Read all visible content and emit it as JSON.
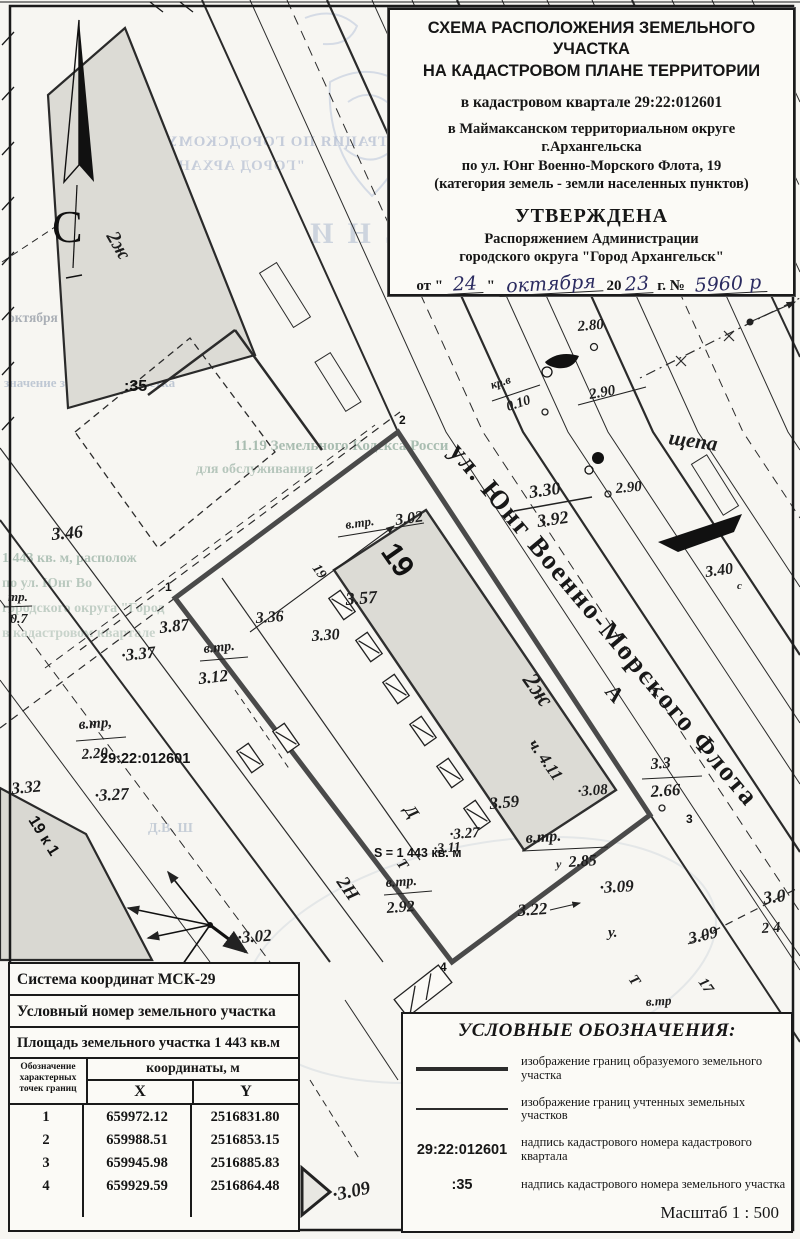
{
  "title_block": {
    "line1": "СХЕМА РАСПОЛОЖЕНИЯ ЗЕМЕЛЬНОГО УЧАСТКА",
    "line2": "НА КАДАСТРОВОМ ПЛАНЕ ТЕРРИТОРИИ",
    "quarter": "в кадастровом квартале 29:22:012601",
    "district1": "в Маймаксанском территориальном округе",
    "district2": "г.Архангельска",
    "address": "по ул. Юнг Военно-Морского Флота, 19",
    "category": "(категория земель - земли населенных пунктов)",
    "approved": "УТВЕРЖДЕНА",
    "approved_by1": "Распоряжением Администрации",
    "approved_by2": "городского округа \"Город Архангельск\"",
    "date_prefix": "от \"",
    "date_day": "24",
    "date_q2": "\"",
    "date_month": "октября",
    "date_20": "20",
    "date_year": "23",
    "date_suffix": "г. №",
    "doc_number": "5960 р"
  },
  "coord_table": {
    "row1": "Система координат МСК-29",
    "row2": "Условный номер земельного участка",
    "row3": "Площадь земельного участка 1 443 кв.м",
    "head_col1a": "Обозначение",
    "head_col1b": "характерных",
    "head_col1c": "точек границ",
    "head_coords": "координаты, м",
    "head_x": "X",
    "head_y": "Y",
    "rows": [
      {
        "n": "1",
        "x": "659972.12",
        "y": "2516831.80"
      },
      {
        "n": "2",
        "x": "659988.51",
        "y": "2516853.15"
      },
      {
        "n": "3",
        "x": "659945.98",
        "y": "2516885.83"
      },
      {
        "n": "4",
        "x": "659929.59",
        "y": "2516864.48"
      }
    ]
  },
  "legend": {
    "title": "УСЛОВНЫЕ ОБОЗНАЧЕНИЯ:",
    "item1_text": "изображение границ образуемого земельного участка",
    "item2_text": "изображение границ учтенных земельных участков",
    "item3_code": "29:22:012601",
    "item3_text": "надпись кадастрового номера кадастрового квартала",
    "item4_code": ":35",
    "item4_text": "надпись кадастрового номера земельного участка",
    "scale": "Масштаб  1 : 500"
  },
  "map": {
    "north_label": "С",
    "area_label": "S = 1 443 кв. м",
    "labels": [
      {
        "t": "С",
        "x": 52,
        "y": 242,
        "r": 0,
        "s": 46,
        "c": "north"
      },
      {
        "t": "ул. Юнг Военно-Морского Флота",
        "x": 448,
        "y": 452,
        "r": 50,
        "s": 27,
        "c": "name"
      },
      {
        "t": "А",
        "x": 604,
        "y": 692,
        "r": 50,
        "s": 22,
        "c": "name"
      },
      {
        "t": "щепа",
        "x": 668,
        "y": 444,
        "r": 8,
        "s": 21,
        "c": "el"
      },
      {
        "t": "2ж",
        "x": 106,
        "y": 236,
        "r": 60,
        "s": 20,
        "c": "el"
      },
      {
        "t": "2ж",
        "x": 522,
        "y": 680,
        "r": 55,
        "s": 24,
        "c": "el"
      },
      {
        "t": "19",
        "x": 380,
        "y": 552,
        "r": 55,
        "s": 30,
        "c": "sans"
      },
      {
        "t": "19",
        "x": 312,
        "y": 568,
        "r": 55,
        "s": 14,
        "c": "el"
      },
      {
        "t": "19 к 1",
        "x": 28,
        "y": 820,
        "r": 58,
        "s": 16,
        "c": "sans"
      },
      {
        "t": "2Н",
        "x": 336,
        "y": 882,
        "r": 55,
        "s": 19,
        "c": "el"
      },
      {
        "t": "Д",
        "x": 404,
        "y": 810,
        "r": 55,
        "s": 17,
        "c": "el"
      },
      {
        "t": "17",
        "x": 698,
        "y": 982,
        "r": 55,
        "s": 15,
        "c": "el"
      },
      {
        "t": "ч. 4.11",
        "x": 528,
        "y": 744,
        "r": 55,
        "s": 17,
        "c": "el"
      },
      {
        "t": ":35",
        "x": 124,
        "y": 391,
        "r": 0,
        "s": 16,
        "c": "sans"
      },
      {
        "t": "29:22:012601",
        "x": 100,
        "y": 763,
        "r": 0,
        "s": 14.5,
        "c": "sans"
      },
      {
        "t": "S = 1 443 кв. м",
        "x": 374,
        "y": 857,
        "r": 0,
        "s": 12.5,
        "c": "sans"
      },
      {
        "t": "1",
        "x": 165,
        "y": 591,
        "r": 0,
        "s": 12,
        "c": "pt"
      },
      {
        "t": "2",
        "x": 399,
        "y": 424,
        "r": 0,
        "s": 12,
        "c": "pt"
      },
      {
        "t": "3",
        "x": 686,
        "y": 823,
        "r": 0,
        "s": 12,
        "c": "pt"
      },
      {
        "t": "4",
        "x": 440,
        "y": 971,
        "r": 0,
        "s": 12,
        "c": "pt"
      },
      {
        "t": "3.46",
        "x": 52,
        "y": 540,
        "r": -5,
        "s": 18,
        "c": "el"
      },
      {
        "t": "тр.",
        "x": 8,
        "y": 601,
        "r": 0,
        "s": 13,
        "c": "el"
      },
      {
        "t": "0.7",
        "x": 10,
        "y": 623,
        "r": 0,
        "s": 14,
        "c": "el"
      },
      {
        "t": "3.87",
        "x": 160,
        "y": 633,
        "r": -6,
        "s": 17,
        "c": "el"
      },
      {
        "t": "·3.37",
        "x": 122,
        "y": 661,
        "r": -6,
        "s": 17,
        "c": "el"
      },
      {
        "t": "в.тр.",
        "x": 204,
        "y": 653,
        "r": -6,
        "s": 14,
        "c": "el"
      },
      {
        "t": "3.12",
        "x": 199,
        "y": 684,
        "r": -6,
        "s": 17,
        "c": "el"
      },
      {
        "t": "в.тр,",
        "x": 79,
        "y": 729,
        "r": -4,
        "s": 15,
        "c": "el"
      },
      {
        "t": "2.20",
        "x": 82,
        "y": 759,
        "r": -4,
        "s": 15,
        "c": "el"
      },
      {
        "t": "3.32",
        "x": 12,
        "y": 794,
        "r": -5,
        "s": 17,
        "c": "el"
      },
      {
        "t": "·3.27",
        "x": 95,
        "y": 801,
        "r": -3,
        "s": 17,
        "c": "el"
      },
      {
        "t": "·3.02",
        "x": 238,
        "y": 943,
        "r": -4,
        "s": 17,
        "c": "el"
      },
      {
        "t": "в.тр.",
        "x": 386,
        "y": 887,
        "r": -4,
        "s": 14,
        "c": "el"
      },
      {
        "t": "2.92",
        "x": 387,
        "y": 913,
        "r": -4,
        "s": 16,
        "c": "el"
      },
      {
        "t": "·3.27",
        "x": 450,
        "y": 839,
        "r": -4,
        "s": 15,
        "c": "el"
      },
      {
        "t": "·3.11",
        "x": 434,
        "y": 853,
        "r": -4,
        "s": 14,
        "c": "el"
      },
      {
        "t": "в.тр.",
        "x": 526,
        "y": 843,
        "r": -4,
        "s": 16,
        "c": "el"
      },
      {
        "t": "у",
        "x": 556,
        "y": 868,
        "r": 0,
        "s": 12,
        "c": "el"
      },
      {
        "t": "2.85",
        "x": 569,
        "y": 867,
        "r": -4,
        "s": 16,
        "c": "el"
      },
      {
        "t": "3.59",
        "x": 490,
        "y": 809,
        "r": -5,
        "s": 17,
        "c": "el"
      },
      {
        "t": "·3.08",
        "x": 578,
        "y": 796,
        "r": -4,
        "s": 15,
        "c": "el"
      },
      {
        "t": "3.3",
        "x": 651,
        "y": 769,
        "r": -4,
        "s": 16,
        "c": "el"
      },
      {
        "t": "2.66",
        "x": 651,
        "y": 797,
        "r": -4,
        "s": 17,
        "c": "el"
      },
      {
        "t": "·3.09",
        "x": 600,
        "y": 893,
        "r": -3,
        "s": 17,
        "c": "el"
      },
      {
        "t": "у.",
        "x": 608,
        "y": 937,
        "r": 0,
        "s": 15,
        "c": "el"
      },
      {
        "t": "3.09",
        "x": 690,
        "y": 944,
        "r": -14,
        "s": 17,
        "c": "el"
      },
      {
        "t": "3.0",
        "x": 764,
        "y": 904,
        "r": -8,
        "s": 18,
        "c": "el"
      },
      {
        "t": "2 4",
        "x": 762,
        "y": 933,
        "r": -4,
        "s": 15,
        "c": "el"
      },
      {
        "t": "в.тр",
        "x": 646,
        "y": 1006,
        "r": -3,
        "s": 13,
        "c": "el"
      },
      {
        "t": "Т",
        "x": 396,
        "y": 863,
        "r": 55,
        "s": 15,
        "c": "el"
      },
      {
        "t": "Т",
        "x": 628,
        "y": 979,
        "r": 55,
        "s": 15,
        "c": "el"
      },
      {
        "t": "3.22",
        "x": 518,
        "y": 916,
        "r": -4,
        "s": 17,
        "c": "el"
      },
      {
        "t": "в.тр.",
        "x": 346,
        "y": 529,
        "r": -8,
        "s": 13,
        "c": "el"
      },
      {
        "t": "3.02",
        "x": 396,
        "y": 525,
        "r": -8,
        "s": 16,
        "c": "el"
      },
      {
        "t": "3.57",
        "x": 346,
        "y": 605,
        "r": -4,
        "s": 18,
        "c": "el"
      },
      {
        "t": "3.36",
        "x": 256,
        "y": 623,
        "r": -4,
        "s": 16,
        "c": "el"
      },
      {
        "t": "3.30",
        "x": 312,
        "y": 641,
        "r": -4,
        "s": 16,
        "c": "el"
      },
      {
        "t": "кр.в",
        "x": 492,
        "y": 389,
        "r": -18,
        "s": 12,
        "c": "el"
      },
      {
        "t": "0.10",
        "x": 508,
        "y": 411,
        "r": -18,
        "s": 14,
        "c": "el"
      },
      {
        "t": "2.90",
        "x": 590,
        "y": 399,
        "r": -10,
        "s": 15,
        "c": "el"
      },
      {
        "t": "2.90",
        "x": 616,
        "y": 493,
        "r": -5,
        "s": 15,
        "c": "el"
      },
      {
        "t": "2.80",
        "x": 578,
        "y": 331,
        "r": -5,
        "s": 15,
        "c": "el"
      },
      {
        "t": "3.40",
        "x": 706,
        "y": 577,
        "r": -8,
        "s": 16,
        "c": "el"
      },
      {
        "t": "с",
        "x": 737,
        "y": 589,
        "r": 0,
        "s": 11,
        "c": "el"
      },
      {
        "t": "3.30",
        "x": 530,
        "y": 498,
        "r": -8,
        "s": 18,
        "c": "el"
      },
      {
        "t": "3.92",
        "x": 538,
        "y": 527,
        "r": -8,
        "s": 18,
        "c": "el"
      },
      {
        "t": "·3.09",
        "x": 334,
        "y": 1201,
        "r": -12,
        "s": 19,
        "c": "el"
      }
    ],
    "bleedthrough": [
      {
        "t": "ТРАЦИЯ ПО ГОРОДСКОМУ ОКРУГУ",
        "x": 388,
        "y": 146,
        "s": 15,
        "color": "#7b90b8",
        "opacity": 0.4,
        "mirror": true,
        "ls": 1
      },
      {
        "t": "\"ГОРОД АРХАНГЕЛЬСК\"",
        "x": 305,
        "y": 170,
        "s": 15,
        "color": "#7b90b8",
        "opacity": 0.38,
        "mirror": true,
        "ls": 1
      },
      {
        "t": "РАСПОРЯЖЕНИ",
        "x": 688,
        "y": 243,
        "s": 30,
        "color": "#8296bb",
        "opacity": 0.35,
        "mirror": true,
        "ls": 14
      },
      {
        "t": "октября 2023 г. №",
        "x": 8,
        "y": 322,
        "s": 13.5,
        "color": "#5f6b7c",
        "opacity": 0.5,
        "mirror": false,
        "ls": 0
      },
      {
        "t": "значение земельного участка",
        "x": 4,
        "y": 387,
        "s": 13,
        "color": "#6e86a8",
        "opacity": 0.4,
        "mirror": false,
        "ls": 0
      },
      {
        "t": "11.19  Земельного  Кодекса  Росси",
        "x": 234,
        "y": 450,
        "s": 15,
        "color": "#5e8672",
        "opacity": 0.5,
        "mirror": false,
        "ls": 0
      },
      {
        "t": "для  обслуживания",
        "x": 196,
        "y": 473,
        "s": 14,
        "color": "#5e8672",
        "opacity": 0.42,
        "mirror": false,
        "ls": 0
      },
      {
        "t": "1 443 кв. м, располож",
        "x": 2,
        "y": 562,
        "s": 14,
        "color": "#5e8672",
        "opacity": 0.45,
        "mirror": false,
        "ls": 0
      },
      {
        "t": "по ул. Юнг Во",
        "x": 2,
        "y": 587,
        "s": 14,
        "color": "#5e8672",
        "opacity": 0.4,
        "mirror": false,
        "ls": 0
      },
      {
        "t": "городского округа \"Город",
        "x": 2,
        "y": 612,
        "s": 14,
        "color": "#5e8672",
        "opacity": 0.35,
        "mirror": false,
        "ls": 0
      },
      {
        "t": "в кадастровом квартале",
        "x": 2,
        "y": 637,
        "s": 14,
        "color": "#5e8672",
        "opacity": 0.3,
        "mirror": false,
        "ls": 0
      },
      {
        "t": "Д.В. Ш",
        "x": 148,
        "y": 832,
        "s": 14,
        "color": "#6e86a8",
        "opacity": 0.35,
        "mirror": false,
        "ls": 0
      }
    ]
  }
}
